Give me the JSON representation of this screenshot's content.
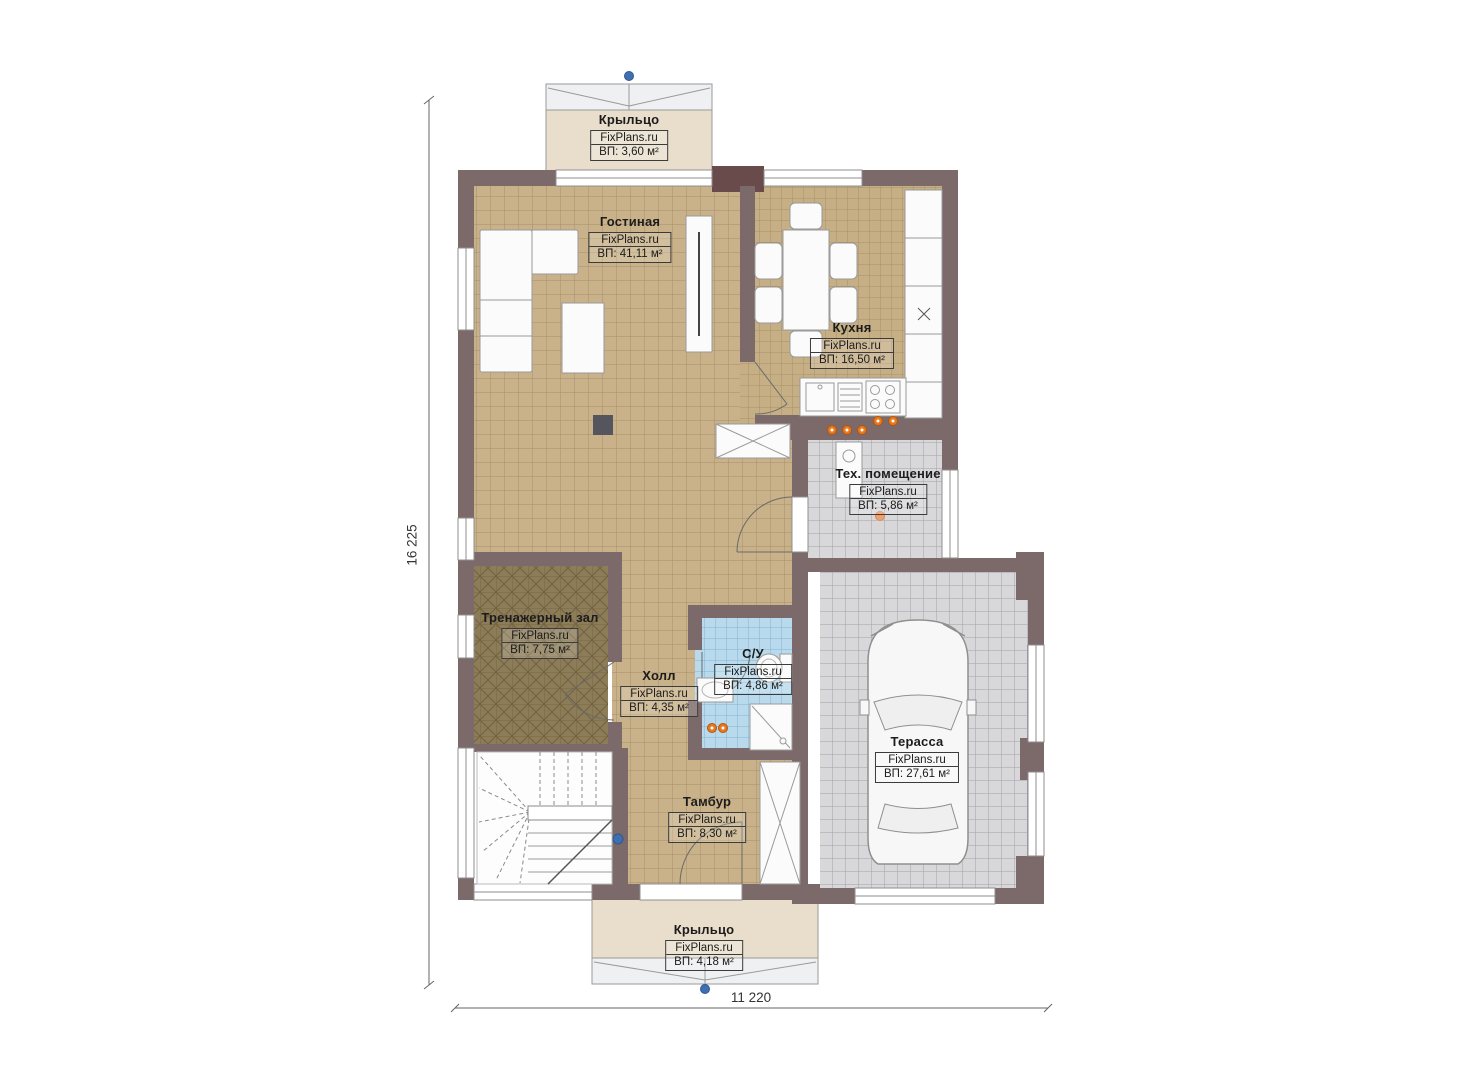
{
  "plan": {
    "brand": "FixPlans.ru",
    "dimensions": {
      "vertical": "16 225",
      "horizontal": "11 220"
    },
    "rooms": {
      "porch_top": {
        "name": "Крыльцо",
        "brand": "FixPlans.ru",
        "area": "ВП: 3,60 м²"
      },
      "living": {
        "name": "Гостиная",
        "brand": "FixPlans.ru",
        "area": "ВП: 41,11 м²"
      },
      "kitchen": {
        "name": "Кухня",
        "brand": "FixPlans.ru",
        "area": "ВП: 16,50 м²"
      },
      "tech": {
        "name": "Тех. помещение",
        "brand": "FixPlans.ru",
        "area": "ВП: 5,86 м²"
      },
      "gym": {
        "name": "Тренажерный зал",
        "brand": "FixPlans.ru",
        "area": "ВП: 7,75 м²"
      },
      "hall": {
        "name": "Холл",
        "brand": "FixPlans.ru",
        "area": "ВП: 4,35 м²"
      },
      "bathroom": {
        "name": "С/У",
        "brand": "FixPlans.ru",
        "area": "ВП: 4,86 м²"
      },
      "tambur": {
        "name": "Тамбур",
        "brand": "FixPlans.ru",
        "area": "ВП: 8,30 м²"
      },
      "terrace": {
        "name": "Терасса",
        "brand": "FixPlans.ru",
        "area": "ВП: 27,61 м²"
      },
      "porch_bottom": {
        "name": "Крыльцо",
        "brand": "FixPlans.ru",
        "area": "ВП: 4,18 м²"
      }
    },
    "colors": {
      "wall": "#7c6a6a",
      "wall_dark": "#6a4b4b",
      "floor_tan": "#c9b189",
      "floor_gray": "#d8d7da",
      "floor_blue": "#b9d9ec",
      "floor_gym": "#8d7c58",
      "porch_beige": "#e8decb",
      "accent_orange": "#e87a1e",
      "marker_blue": "#3f6fae"
    }
  }
}
